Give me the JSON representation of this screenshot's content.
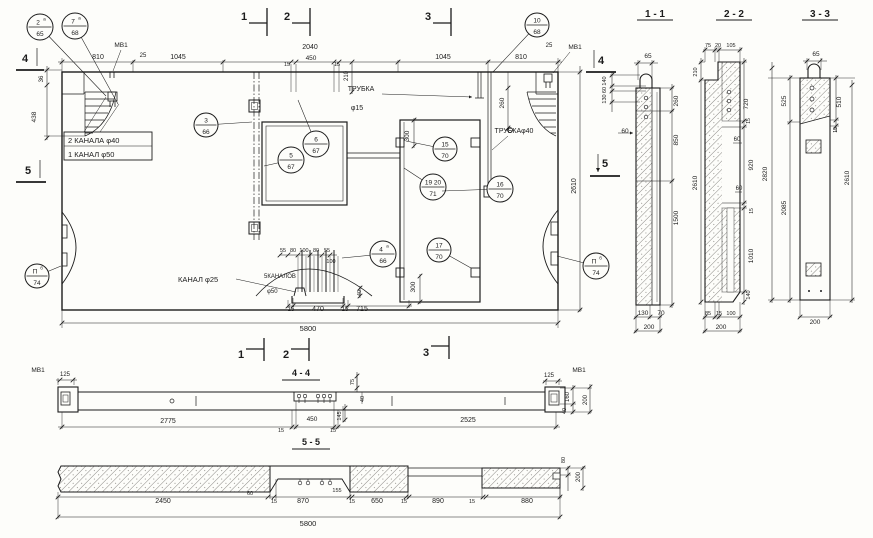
{
  "texts": {
    "t11": "1 - 1",
    "t22": "2 - 2",
    "t33": "3 - 3",
    "t44": "4 - 4",
    "t55": "5 - 5",
    "mt1": "1",
    "mt2": "2",
    "mt3": "3",
    "mb1": "1",
    "mb2": "2",
    "mb3": "3",
    "ml4": "4",
    "ml5": "5",
    "mr4": "4",
    "mr5": "5",
    "mv_tl": "МВ1",
    "mv_tr": "МВ1",
    "mv_44l": "МВ1",
    "mv_44r": "МВ1",
    "p25l": "25",
    "p810l": "810",
    "p1045l": "1045",
    "p2040": "2040",
    "p15a": "15",
    "p450": "450",
    "p15b": "15",
    "p210": "210",
    "p1045r": "1045",
    "p810r": "810",
    "p25r": "25",
    "p36": "36",
    "p438": "438",
    "p260": "260",
    "p2610": "2610",
    "p300t": "300",
    "p300b": "300",
    "p55a": "55",
    "p80a": "80",
    "p100a": "100",
    "p80b": "80",
    "p55b": "55",
    "p100c": "100",
    "p40": "40",
    "p15c": "15",
    "p470": "470",
    "p15d": "15",
    "p715": "715",
    "p5800": "5800",
    "n_tr15a": "ТРУБКА",
    "n_tr15b": "φ15",
    "n_tr40": "ТРУБКАφ40",
    "n_k40": "2 КАНАЛА φ40",
    "n_k50": "1 КАНАЛ φ50",
    "n_k25": "КАНАЛ φ25",
    "n_k5": "5КАНАЛОВ",
    "n_f50": "φ50",
    "a65": "65",
    "a140": "140",
    "a60a": "60",
    "a130": "130",
    "a60b": "60",
    "a260": "260",
    "a850": "850",
    "a1500": "1500",
    "a130b": "130",
    "a70": "70",
    "a200": "200",
    "b75": "75",
    "b20": "20",
    "b105": "105",
    "b210": "210",
    "b2610": "2610",
    "b720": "720",
    "b15a": "15",
    "b60a": "60",
    "b920": "920",
    "b60b": "60",
    "b15b": "15",
    "b1010": "1010",
    "b140": "140",
    "b85": "85",
    "b15c": "15",
    "b100": "100",
    "b200": "200",
    "c65": "65",
    "c525": "525",
    "c2820": "2820",
    "c2085": "2085",
    "c510": "510",
    "c15": "15",
    "c2610": "2610",
    "c200": "200",
    "d125l": "125",
    "d2775": "2775",
    "d75": "75",
    "d40a": "40",
    "d145": "145",
    "d450": "450",
    "d15l": "15",
    "d15r": "15",
    "d2525": "2525",
    "d125r": "125",
    "d160": "160",
    "d200": "200",
    "d40b": "40",
    "e2450": "2450",
    "e60": "60",
    "e15a": "15",
    "e870": "870",
    "e155": "155",
    "e15b": "15",
    "e650": "650",
    "e15c": "15",
    "e890": "890",
    "e15d": "15",
    "e880": "880",
    "e80": "80",
    "e200": "200",
    "e5800": "5800"
  },
  "callouts": [
    {
      "top": "2",
      "sup": "a",
      "bottom": "65"
    },
    {
      "top": "7",
      "sup": "a",
      "bottom": "68"
    },
    {
      "top": "10",
      "sup": "",
      "bottom": "68"
    },
    {
      "top": "3",
      "sup": "",
      "bottom": "66"
    },
    {
      "top": "6",
      "sup": "",
      "bottom": "67"
    },
    {
      "top": "5",
      "sup": "",
      "bottom": "67"
    },
    {
      "top": "15",
      "sup": "",
      "bottom": "70"
    },
    {
      "top": "19 20",
      "sup": "",
      "bottom": "71"
    },
    {
      "top": "16",
      "sup": "",
      "bottom": "70"
    },
    {
      "top": "17",
      "sup": "",
      "bottom": "70"
    },
    {
      "top": "4",
      "sup": "a",
      "bottom": "66"
    },
    {
      "top": "П",
      "sup": "б",
      "bottom": "74"
    },
    {
      "top": "П",
      "sup": "б",
      "bottom": "74"
    }
  ]
}
